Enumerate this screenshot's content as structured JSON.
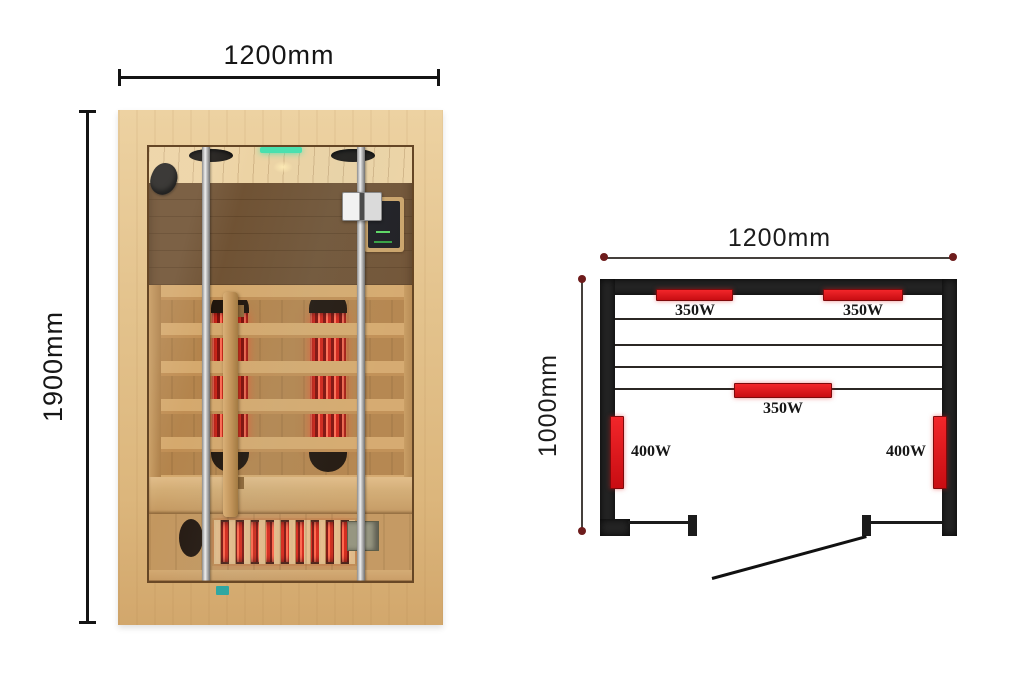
{
  "front_view": {
    "width_label": "1200mm",
    "height_label": "1900mm"
  },
  "floor_plan": {
    "width_label": "1200mm",
    "depth_label": "1000mm",
    "heaters": [
      {
        "id": "top-left",
        "power": "350W",
        "orientation": "horizontal"
      },
      {
        "id": "top-right",
        "power": "350W",
        "orientation": "horizontal"
      },
      {
        "id": "center",
        "power": "350W",
        "orientation": "horizontal"
      },
      {
        "id": "left-wall",
        "power": "400W",
        "orientation": "vertical"
      },
      {
        "id": "right-wall",
        "power": "400W",
        "orientation": "vertical"
      }
    ],
    "colors": {
      "heater_red": "#e01419",
      "wall_dark": "#242424",
      "dimension_dot": "#6e1c1c",
      "dimension_line": "#45403c"
    }
  }
}
